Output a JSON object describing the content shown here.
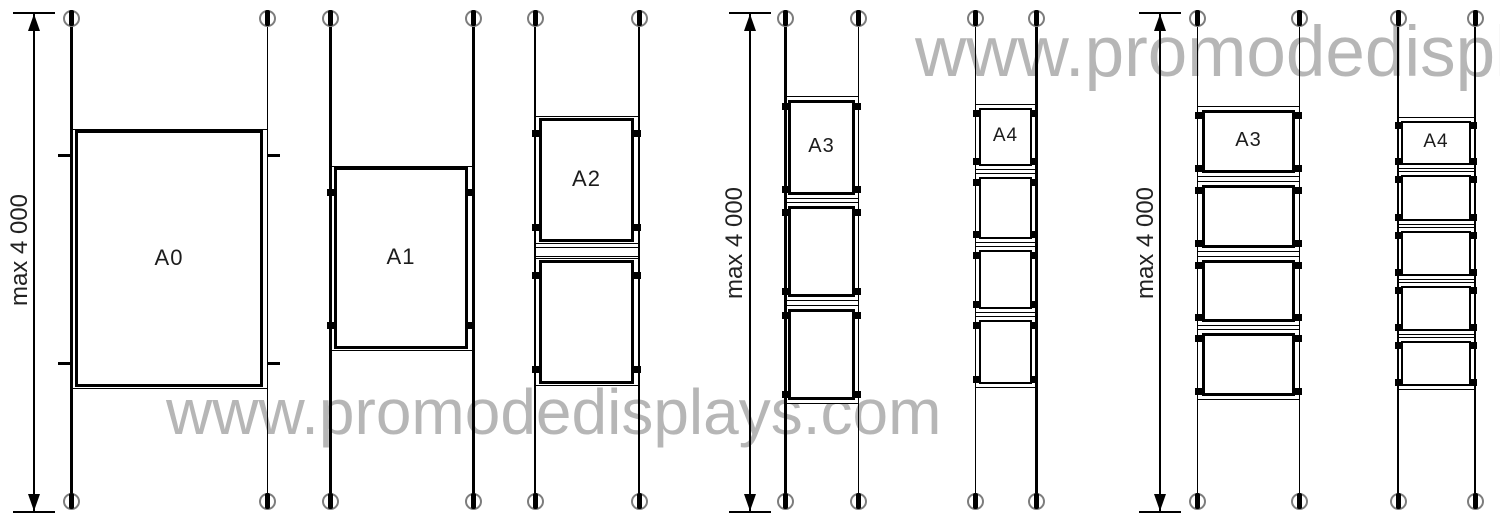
{
  "canvas": {
    "width": 1500,
    "height": 529,
    "background": "#ffffff",
    "line_color": "#000000"
  },
  "watermark": {
    "top_text": "www.promodedispla",
    "bottom_text": "www.promodedisplays.com",
    "color": "#b6b6b6",
    "top_pos": {
      "left": 915,
      "top": 17,
      "font_size": 71
    },
    "bottom_pos": {
      "left": 166,
      "top": 380,
      "font_size": 64
    }
  },
  "dimension_label": "max 4 000",
  "dimension_font_size": 24,
  "dimensions": [
    {
      "line_x": 34,
      "top": 13,
      "bottom": 512,
      "bar_half": 21,
      "label_cx": 20,
      "label_cy": 250
    },
    {
      "line_x": 750,
      "top": 13,
      "bottom": 512,
      "bar_half": 21,
      "label_cx": 735,
      "label_cy": 243
    },
    {
      "line_x": 1160,
      "top": 13,
      "bottom": 512,
      "bar_half": 21,
      "label_cx": 1146,
      "label_cy": 243
    }
  ],
  "cable_top": 26,
  "cable_bottom": 494,
  "fixing": {
    "top_cy": 18,
    "bottom_cy": 501,
    "ring_d": 13,
    "ring_color": "#7d7d7d",
    "slot_w": 5,
    "slot_h": 16
  },
  "cables": [
    {
      "x": 70,
      "w": 3
    },
    {
      "x": 267,
      "w": 1
    },
    {
      "x": 329,
      "w": 3
    },
    {
      "x": 472,
      "w": 3
    },
    {
      "x": 534,
      "w": 2
    },
    {
      "x": 638,
      "w": 2
    },
    {
      "x": 784,
      "w": 3
    },
    {
      "x": 858,
      "w": 1
    },
    {
      "x": 975,
      "w": 1
    },
    {
      "x": 1035,
      "w": 3
    },
    {
      "x": 1197,
      "w": 1
    },
    {
      "x": 1299,
      "w": 1
    },
    {
      "x": 1397,
      "w": 2
    },
    {
      "x": 1474,
      "w": 2
    }
  ],
  "groups": [
    {
      "name": "poster-a0",
      "x": 70,
      "w": 198,
      "bold_border": 3,
      "inset": {
        "l": 5,
        "r": 5,
        "t": 1,
        "b": 2
      },
      "label_size": 22,
      "clamp": "tick",
      "clamp_inset": 26,
      "panels": [
        {
          "y": 129,
          "h": 260,
          "label": "A0"
        }
      ]
    },
    {
      "name": "poster-a1",
      "x": 329,
      "w": 144,
      "bold_border": 3,
      "inset": {
        "l": 5,
        "r": 5,
        "t": 1,
        "b": 2
      },
      "label_size": 22,
      "clamp": "square",
      "clamp_inset": 26,
      "panels": [
        {
          "y": 166,
          "h": 185,
          "label": "A1"
        }
      ]
    },
    {
      "name": "poster-a2",
      "x": 534,
      "w": 105,
      "bold_border": 3,
      "inset": {
        "l": 5,
        "r": 5,
        "t": 2,
        "b": 2
      },
      "label_size": 22,
      "clamp": "square",
      "clamp_inset": 17,
      "panels": [
        {
          "y": 116,
          "h": 128,
          "label": "A2"
        },
        {
          "y": 258,
          "h": 128
        }
      ],
      "rails": [
        {
          "y": 247,
          "h": 10
        }
      ]
    },
    {
      "name": "poster-a3-portrait",
      "x": 784,
      "w": 75,
      "bold_border": 3,
      "inset": {
        "l": 4,
        "r": 4,
        "t": 4,
        "b": 4
      },
      "label_size": 20,
      "clamp": "square",
      "clamp_inset": 10,
      "panels": [
        {
          "y": 96,
          "h": 103,
          "label": "A3"
        },
        {
          "y": 202,
          "h": 99
        },
        {
          "y": 305,
          "h": 99
        }
      ]
    },
    {
      "name": "poster-a4-portrait",
      "x": 975,
      "w": 61,
      "bold_border": 2,
      "inset": {
        "l": 4,
        "r": 4,
        "t": 4,
        "b": 4
      },
      "label_size": 19,
      "clamp": "square",
      "clamp_inset": 9,
      "panels": [
        {
          "y": 104,
          "h": 66,
          "label": "A4"
        },
        {
          "y": 173,
          "h": 70
        },
        {
          "y": 246,
          "h": 67
        },
        {
          "y": 316,
          "h": 72
        }
      ]
    },
    {
      "name": "poster-a3-landscape",
      "x": 1197,
      "w": 103,
      "bold_border": 3,
      "inset": {
        "l": 5,
        "r": 5,
        "t": 4,
        "b": 4
      },
      "label_size": 20,
      "clamp": "square",
      "clamp_inset": 9,
      "panels": [
        {
          "y": 106,
          "h": 71,
          "label": "A3"
        },
        {
          "y": 181,
          "h": 71
        },
        {
          "y": 256,
          "h": 70
        },
        {
          "y": 329,
          "h": 71
        }
      ]
    },
    {
      "name": "poster-a4-landscape",
      "x": 1397,
      "w": 78,
      "bold_border": 2,
      "inset": {
        "l": 4,
        "r": 4,
        "t": 4,
        "b": 4
      },
      "label_size": 19,
      "clamp": "square",
      "clamp_inset": 8,
      "panels": [
        {
          "y": 117,
          "h": 52,
          "label": "A4"
        },
        {
          "y": 171,
          "h": 54
        },
        {
          "y": 227,
          "h": 53
        },
        {
          "y": 282,
          "h": 53
        },
        {
          "y": 337,
          "h": 53
        }
      ]
    }
  ]
}
